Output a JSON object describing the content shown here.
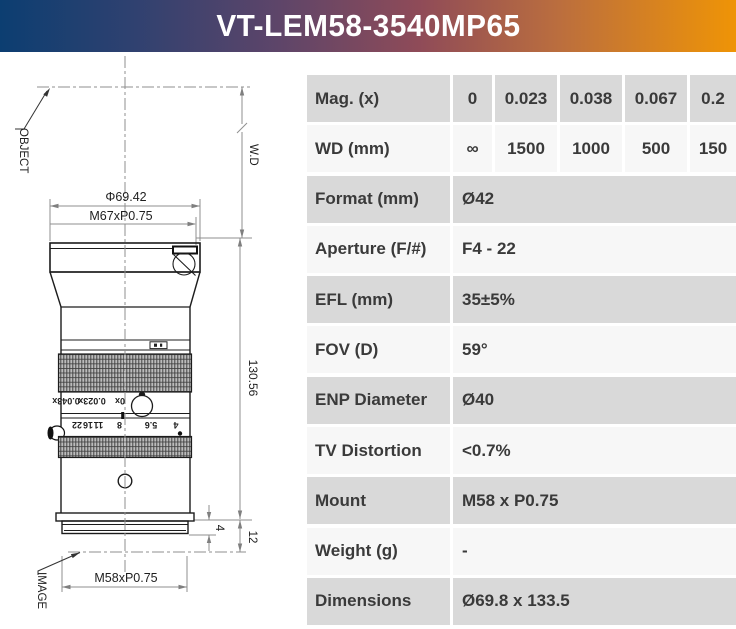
{
  "header": {
    "title": "VT-LEM58-3540MP65"
  },
  "colors": {
    "header_gradient_left": "#0c3e71",
    "header_gradient_mid": "#8f4b58",
    "header_gradient_right": "#ef9406",
    "row_grey": "#d9d9d9",
    "row_light": "#f7f7f7",
    "table_text": "#3a3a3a"
  },
  "drawing": {
    "object_label": "OBJECT",
    "image_label": "IMAGE",
    "wd_label": "W.D",
    "front_diameter": "Φ69.42",
    "front_thread": "M67xP0.75",
    "length": "130.56",
    "mount_thread": "M58xP0.75",
    "mount_dim": "4",
    "back_focal_dim": "12",
    "mag_scale": [
      "0.043x",
      "0.023x",
      "0x"
    ],
    "aperture_scale": [
      "22",
      "16",
      "11",
      "8",
      "5.6",
      "4"
    ]
  },
  "spec_table": {
    "rows": [
      {
        "label": "Mag. (x)",
        "values": [
          "0",
          "0.023",
          "0.038",
          "0.067",
          "0.2"
        ]
      },
      {
        "label": "WD (mm)",
        "values": [
          "∞",
          "1500",
          "1000",
          "500",
          "150"
        ]
      },
      {
        "label": "Format (mm)",
        "value": "Ø42"
      },
      {
        "label": "Aperture (F/#)",
        "value": "F4 - 22"
      },
      {
        "label": "EFL (mm)",
        "value": "35±5%"
      },
      {
        "label": "FOV (D)",
        "value": "59°"
      },
      {
        "label": "ENP Diameter",
        "value": "Ø40"
      },
      {
        "label": "TV Distortion",
        "value": "<0.7%"
      },
      {
        "label": "Mount",
        "value": "M58 x P0.75"
      },
      {
        "label": "Weight (g)",
        "value": "-"
      },
      {
        "label": "Dimensions",
        "value": "Ø69.8 x 133.5"
      }
    ]
  }
}
